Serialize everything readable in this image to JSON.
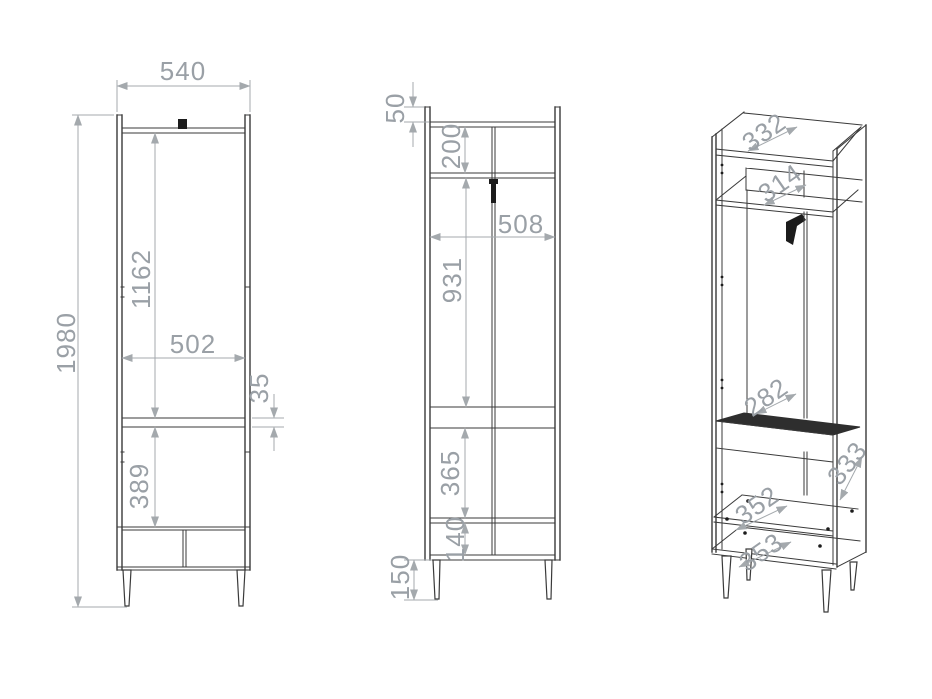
{
  "drawing": {
    "type": "furniture technical drawing, three views of a tall wardrobe cabinet",
    "colors": {
      "background": "#ffffff",
      "cabinet_line": "#3a3a3a",
      "dimension_line": "#a4a9ad",
      "dimension_text": "#9aa0a6",
      "hardware_black": "#1c1c1c"
    }
  },
  "views": {
    "front": {
      "label": "front-elevation",
      "dims": {
        "width_top": "540",
        "total_height": "1980",
        "interior_height": "1162",
        "interior_width": "502",
        "shelf_thickness": "35",
        "lower_compartment_height": "389"
      }
    },
    "side": {
      "label": "side-section",
      "dims": {
        "top_lip": "50",
        "top_compartment_height": "200",
        "interior_depth": "508",
        "hanging_space_height": "931",
        "lower_compartment_height": "365",
        "drawer_zone_height": "140",
        "leg_height": "150"
      }
    },
    "iso": {
      "label": "isometric-interior",
      "dims": {
        "top_panel_depth": "332",
        "top_shelf_depth": "314",
        "back_rail_width": "282",
        "side_panel_depth": "333",
        "lower_shelf_depth": "352",
        "bottom_panel_depth": "353"
      }
    }
  }
}
